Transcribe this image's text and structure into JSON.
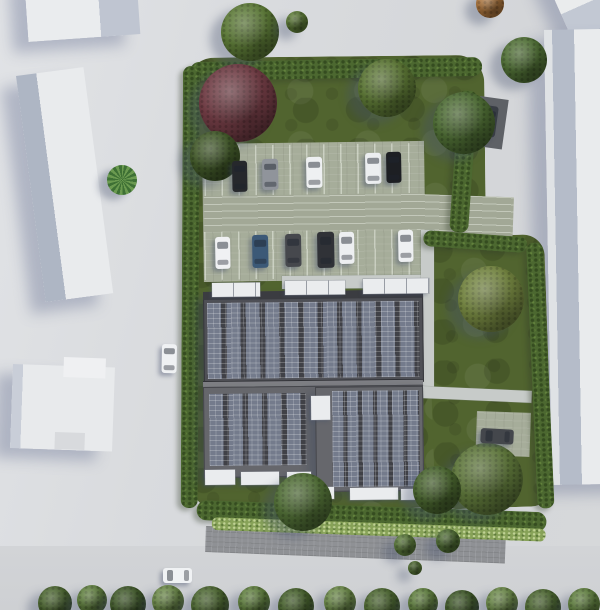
{
  "meta": {
    "description": "Aerial 3D architectural rendering of a residential site: apartment building with rooftop solar panels, parking lot with cars, lawns with hedges and trees, surrounded by gray roads and neighboring white buildings",
    "canvas": {
      "w": 600,
      "h": 610
    }
  },
  "palette": {
    "road": "#d7d9dc",
    "grass": "#51642f",
    "hedge": "#4c6830",
    "shrub": "#87a258",
    "pavers": "#a6ad9a",
    "lane": "#a2a896",
    "path": "#c7cbc9",
    "brick": "#8f9195",
    "roof_dark": "#4f5056",
    "roof_mid": "#66676c",
    "panel": "#747b8c",
    "panel_gap": "#404147",
    "white_trim": "#eaecee",
    "building_white": "#e9ebed",
    "building_facet": "#b2bac8",
    "shadow": "rgba(100,110,145,0.38)"
  },
  "scene": {
    "shapes": [
      {
        "name": "road-south",
        "x": 0,
        "y": 546,
        "w": 600,
        "h": 64,
        "fill": "linear-gradient(180deg,#d2d4d7,#ced0d3)"
      },
      {
        "name": "neighbor-building-top-left",
        "cls": "nb",
        "x": 24,
        "y": -24,
        "w": 112,
        "h": 66,
        "rot": -4,
        "fill": "linear-gradient(90deg,#eaecee 0 65%,#bfc5d1 65%)"
      },
      {
        "name": "neighbor-building-left",
        "cls": "nb",
        "x": 16,
        "y": 76,
        "w": 68,
        "h": 228,
        "rot": -7.5,
        "fill": "linear-gradient(90deg,#aeb6c4 0 30%,#e9ebed 30%)"
      },
      {
        "name": "neighbor-building-bottom-left",
        "cls": "nb",
        "x": 13,
        "y": 364,
        "w": 102,
        "h": 84,
        "rot": 2,
        "fill": "linear-gradient(90deg,#c9ced8 0 10%,#e8eaec 10%)"
      },
      {
        "name": "neighbor-building-bottom-left-step",
        "x": 64,
        "y": 357,
        "w": 42,
        "h": 20,
        "rot": 2,
        "fill": "#eff0f2"
      },
      {
        "name": "neighbor-building-bottom-left-notch",
        "x": 55,
        "y": 432,
        "w": 30,
        "h": 17,
        "rot": 2,
        "fill": "#d8dadd"
      },
      {
        "name": "neighbor-building-top-right",
        "cls": "nb",
        "x": 528,
        "y": -60,
        "w": 150,
        "h": 110,
        "rot": -24,
        "fill": "linear-gradient(180deg,#eaeced 0 74%,#c2c8d3 74%)"
      },
      {
        "name": "neighbor-building-right",
        "cls": "nb",
        "x": 544,
        "y": 30,
        "w": 100,
        "h": 455,
        "rot": -1,
        "fill": "linear-gradient(90deg,#dfe2e5 0 8px,#b5bcc9 8px 30px,#e9ebed 30px)"
      },
      {
        "name": "sidewalk-south",
        "cls": "brick",
        "x": 206,
        "y": 526,
        "w": 300,
        "h": 26,
        "rot": 2.2
      },
      {
        "name": "site-lawn-main",
        "cls": "grass",
        "x": 186,
        "y": 58,
        "w": 298,
        "h": 452,
        "rot": -0.6,
        "r": 28
      },
      {
        "name": "site-lawn-east",
        "cls": "grass",
        "x": 426,
        "y": 238,
        "w": 118,
        "h": 272,
        "rot": -2,
        "r": 22
      },
      {
        "name": "parking-lot-surface",
        "cls": "pavers",
        "x": 202,
        "y": 144,
        "w": 222,
        "h": 138,
        "rot": -0.8
      },
      {
        "name": "parking-stall-row-north",
        "cls": "stalls",
        "x": 204,
        "y": 146,
        "w": 218,
        "h": 50,
        "rot": -0.8
      },
      {
        "name": "parking-lane",
        "cls": "lane",
        "x": 204,
        "y": 196,
        "w": 218,
        "h": 36,
        "rot": -0.8
      },
      {
        "name": "parking-stall-row-south",
        "cls": "stalls",
        "x": 204,
        "y": 232,
        "w": 218,
        "h": 48,
        "rot": -0.8
      },
      {
        "name": "access-road-east",
        "cls": "lane",
        "x": 418,
        "y": 194,
        "w": 96,
        "h": 42,
        "rot": 2
      },
      {
        "name": "path-building-north",
        "cls": "path",
        "x": 282,
        "y": 276,
        "w": 146,
        "h": 13,
        "rot": -0.5
      },
      {
        "name": "path-east-vertical",
        "cls": "path",
        "x": 421,
        "y": 230,
        "w": 13,
        "h": 160
      },
      {
        "name": "path-east-horizontal",
        "cls": "path",
        "x": 420,
        "y": 386,
        "w": 112,
        "h": 12,
        "rot": 2.5
      },
      {
        "name": "parking-pad-southeast",
        "cls": "pavers",
        "x": 477,
        "y": 411,
        "w": 54,
        "h": 44,
        "rot": 2
      },
      {
        "name": "parking-pad-northeast",
        "x": 480,
        "y": 96,
        "w": 29,
        "h": 50,
        "rot": 8,
        "fill": "#5e6166"
      },
      {
        "name": "hedge-top",
        "cls": "hedge",
        "x": 190,
        "y": 62,
        "w": 292,
        "h": 19,
        "rot": -1,
        "r": 10
      },
      {
        "name": "hedge-left",
        "cls": "hedge",
        "x": 183,
        "y": 66,
        "w": 17,
        "h": 442,
        "rot": 0.3,
        "r": 8
      },
      {
        "name": "hedge-right-upper",
        "cls": "hedge",
        "x": 459,
        "y": 90,
        "w": 19,
        "h": 142,
        "rot": 4,
        "r": 8
      },
      {
        "name": "hedge-access-south",
        "cls": "hedge",
        "x": 424,
        "y": 230,
        "w": 104,
        "h": 16,
        "rot": 4,
        "r": 8
      },
      {
        "name": "hedge-east",
        "cls": "hedge",
        "x": 526,
        "y": 243,
        "w": 17,
        "h": 266,
        "rot": -2.5,
        "r": 8
      },
      {
        "name": "hedge-bottom",
        "cls": "hedge",
        "x": 197,
        "y": 500,
        "w": 350,
        "h": 20,
        "rot": 2,
        "r": 10
      },
      {
        "name": "shrub-strip-south",
        "cls": "shrub",
        "x": 212,
        "y": 517,
        "w": 334,
        "h": 13,
        "rot": 2,
        "r": 6
      },
      {
        "name": "building-block-north",
        "cls": "roof-dark",
        "x": 203,
        "y": 292,
        "w": 220,
        "h": 92,
        "rot": -0.6
      },
      {
        "name": "building-north-eave",
        "x": 203,
        "y": 292,
        "w": 220,
        "h": 8,
        "rot": -0.6,
        "fill": "#3b3c41"
      },
      {
        "name": "solar-panels-north",
        "cls": "panels",
        "x": 207,
        "y": 303,
        "w": 212,
        "h": 76,
        "rot": -0.6,
        "vars": {
          "--pw": "14px",
          "--period": "19.3px"
        }
      },
      {
        "name": "building-ridge",
        "cls": "ridge",
        "x": 203,
        "y": 381,
        "w": 220,
        "h": 7,
        "rot": -0.6,
        "fill": "#7e7f84"
      },
      {
        "name": "building-block-south",
        "cls": "roof-mid",
        "x": 203,
        "y": 387,
        "w": 220,
        "h": 91,
        "rot": -0.6
      },
      {
        "name": "building-block-south-ext",
        "cls": "roof-mid",
        "x": 315,
        "y": 387,
        "w": 108,
        "h": 105,
        "rot": -0.6
      },
      {
        "name": "solar-panels-south-left",
        "cls": "panels",
        "x": 209,
        "y": 394,
        "w": 97,
        "h": 72,
        "rot": -0.6,
        "vars": {
          "--pw": "14px",
          "--period": "19.4px"
        }
      },
      {
        "name": "solar-panels-south-right",
        "cls": "panels",
        "x": 332,
        "y": 391,
        "w": 87,
        "h": 96,
        "rot": -0.6,
        "vars": {
          "--pw": "11px",
          "--period": "15px"
        }
      },
      {
        "name": "roof-skylight",
        "cls": "white-box",
        "x": 311,
        "y": 396,
        "w": 19,
        "h": 24,
        "rot": -0.6
      },
      {
        "name": "roof-terrace-1",
        "cls": "white-box divided",
        "x": 212,
        "y": 283,
        "w": 48,
        "h": 14,
        "rot": -0.6
      },
      {
        "name": "roof-terrace-2",
        "cls": "white-box divided",
        "x": 285,
        "y": 281,
        "w": 60,
        "h": 14,
        "rot": -0.6
      },
      {
        "name": "roof-terrace-3",
        "cls": "white-box divided",
        "x": 363,
        "y": 279,
        "w": 66,
        "h": 15,
        "rot": -0.6
      },
      {
        "name": "south-balcony-1",
        "cls": "white-box",
        "x": 205,
        "y": 470,
        "w": 30,
        "h": 15,
        "rot": -0.6
      },
      {
        "name": "south-balcony-2",
        "cls": "white-box",
        "x": 241,
        "y": 472,
        "w": 38,
        "h": 13,
        "rot": -0.6
      },
      {
        "name": "south-balcony-3",
        "cls": "white-box",
        "x": 287,
        "y": 472,
        "w": 24,
        "h": 14,
        "rot": -0.6
      },
      {
        "name": "south-balcony-4",
        "cls": "white-box",
        "x": 317,
        "y": 487,
        "w": 17,
        "h": 12,
        "rot": -0.6
      },
      {
        "name": "south-balcony-5",
        "cls": "white-box",
        "x": 350,
        "y": 488,
        "w": 48,
        "h": 12,
        "rot": -0.6
      },
      {
        "name": "south-balcony-6",
        "cls": "white-box",
        "x": 401,
        "y": 489,
        "w": 18,
        "h": 11,
        "rot": -0.6
      }
    ],
    "trees": [
      {
        "name": "tree-top-big",
        "x": 250,
        "y": 32,
        "r": 29,
        "color": "#5b7836"
      },
      {
        "name": "tree-top-small",
        "x": 297,
        "y": 22,
        "r": 11,
        "color": "#5e7c38"
      },
      {
        "name": "tree-orange-top",
        "x": 490,
        "y": 4,
        "r": 14,
        "color": "#ad763e"
      },
      {
        "name": "tree-road-east",
        "x": 524,
        "y": 60,
        "r": 23,
        "color": "#4f6e35"
      },
      {
        "name": "palm-plaza",
        "cls": "palm",
        "x": 122,
        "y": 180,
        "r": 15,
        "color": "#3e7034"
      },
      {
        "name": "tree-maroon-northwest",
        "x": 238,
        "y": 103,
        "r": 39,
        "color": "#6d3a42"
      },
      {
        "name": "bush-northwest",
        "x": 215,
        "y": 156,
        "r": 25,
        "color": "#415829"
      },
      {
        "name": "tree-lawn-northeast",
        "x": 387,
        "y": 88,
        "r": 29,
        "color": "#5a7434"
      },
      {
        "name": "tree-east-big",
        "x": 491,
        "y": 299,
        "r": 33,
        "color": "#71823f"
      },
      {
        "name": "tree-southeast-big",
        "x": 487,
        "y": 479,
        "r": 36,
        "color": "#5c7439"
      },
      {
        "name": "tree-southeast-small",
        "x": 437,
        "y": 490,
        "r": 24,
        "color": "#48632e"
      },
      {
        "name": "tree-southwest-walk",
        "x": 303,
        "y": 502,
        "r": 29,
        "color": "#4f6c35"
      },
      {
        "name": "bush-walk-1",
        "x": 405,
        "y": 545,
        "r": 11,
        "color": "#5d7c3c"
      },
      {
        "name": "bush-walk-2",
        "x": 448,
        "y": 541,
        "r": 12,
        "color": "#527036"
      },
      {
        "name": "bush-walk-3",
        "x": 415,
        "y": 568,
        "r": 7,
        "color": "#5d7c3c"
      }
    ],
    "cars": [
      {
        "name": "parked-car-north-1",
        "x": 232,
        "y": 161,
        "w": 15,
        "h": 31,
        "rot": -1,
        "color": "#26282c",
        "dir": "v"
      },
      {
        "name": "parked-car-north-2",
        "x": 262,
        "y": 159,
        "w": 16,
        "h": 31,
        "rot": -1,
        "color": "#90949b",
        "dir": "v"
      },
      {
        "name": "parked-car-north-3",
        "x": 306,
        "y": 157,
        "w": 16,
        "h": 31,
        "rot": -1,
        "color": "#eef0f2",
        "dir": "v"
      },
      {
        "name": "parked-car-north-4",
        "x": 365,
        "y": 153,
        "w": 16,
        "h": 31,
        "rot": -1,
        "color": "#eceef0",
        "dir": "v"
      },
      {
        "name": "parked-car-north-5",
        "x": 386,
        "y": 152,
        "w": 15,
        "h": 31,
        "rot": -1,
        "color": "#1d1f23",
        "dir": "v"
      },
      {
        "name": "parked-car-south-1",
        "x": 215,
        "y": 237,
        "w": 15,
        "h": 32,
        "rot": -1,
        "color": "#f0f1f3",
        "dir": "v"
      },
      {
        "name": "parked-car-south-2",
        "x": 252,
        "y": 235,
        "w": 16,
        "h": 33,
        "rot": -1,
        "color": "#3c5977",
        "dir": "v"
      },
      {
        "name": "parked-car-south-3",
        "x": 285,
        "y": 234,
        "w": 16,
        "h": 33,
        "rot": -1,
        "color": "#46484d",
        "dir": "v"
      },
      {
        "name": "parked-van-south-4",
        "x": 317,
        "y": 232,
        "w": 17,
        "h": 36,
        "rot": -1,
        "color": "#303237",
        "dir": "v"
      },
      {
        "name": "parked-car-south-5",
        "x": 339,
        "y": 232,
        "w": 15,
        "h": 32,
        "rot": -1,
        "color": "#edeff1",
        "dir": "v"
      },
      {
        "name": "parked-car-south-6",
        "x": 398,
        "y": 230,
        "w": 15,
        "h": 32,
        "rot": -1,
        "color": "#eef0f2",
        "dir": "v"
      },
      {
        "name": "street-car-left-road",
        "x": 162,
        "y": 344,
        "w": 15,
        "h": 29,
        "rot": 1,
        "color": "#eff1f3",
        "dir": "v"
      },
      {
        "name": "street-car-bottom-road",
        "x": 163,
        "y": 568,
        "w": 29,
        "h": 15,
        "rot": 0,
        "color": "#f0f2f4",
        "dir": "h"
      },
      {
        "name": "parked-car-northeast-pad",
        "x": 485,
        "y": 105,
        "w": 14,
        "h": 31,
        "rot": 8,
        "color": "#383d44",
        "dir": "v"
      },
      {
        "name": "parked-car-southeast-spot",
        "x": 481,
        "y": 428,
        "w": 33,
        "h": 15,
        "rot": 3,
        "color": "#44474c",
        "dir": "h"
      }
    ],
    "trees_top": [
      {
        "name": "tree-northeast-pad",
        "x": 464,
        "y": 123,
        "r": 31,
        "color": "#4c6a33"
      }
    ],
    "tree_row": [
      {
        "x": 55,
        "y": 603,
        "r": 17,
        "color": "#4b6530"
      },
      {
        "x": 92,
        "y": 600,
        "r": 15,
        "color": "#5f7e3e"
      },
      {
        "x": 128,
        "y": 604,
        "r": 18,
        "color": "#3f5829"
      },
      {
        "x": 168,
        "y": 601,
        "r": 16,
        "color": "#6a8748"
      },
      {
        "x": 210,
        "y": 605,
        "r": 19,
        "color": "#4b6530"
      },
      {
        "x": 254,
        "y": 602,
        "r": 16,
        "color": "#5f7e3e"
      },
      {
        "x": 296,
        "y": 606,
        "r": 18,
        "color": "#46602c"
      },
      {
        "x": 340,
        "y": 602,
        "r": 16,
        "color": "#6a8748"
      },
      {
        "x": 382,
        "y": 606,
        "r": 18,
        "color": "#4b6530"
      },
      {
        "x": 423,
        "y": 603,
        "r": 15,
        "color": "#5f7e3e"
      },
      {
        "x": 462,
        "y": 607,
        "r": 17,
        "color": "#3f5829"
      },
      {
        "x": 502,
        "y": 603,
        "r": 16,
        "color": "#6a8748"
      },
      {
        "x": 543,
        "y": 607,
        "r": 18,
        "color": "#4b6530"
      },
      {
        "x": 584,
        "y": 604,
        "r": 16,
        "color": "#5f7e3e"
      }
    ]
  }
}
